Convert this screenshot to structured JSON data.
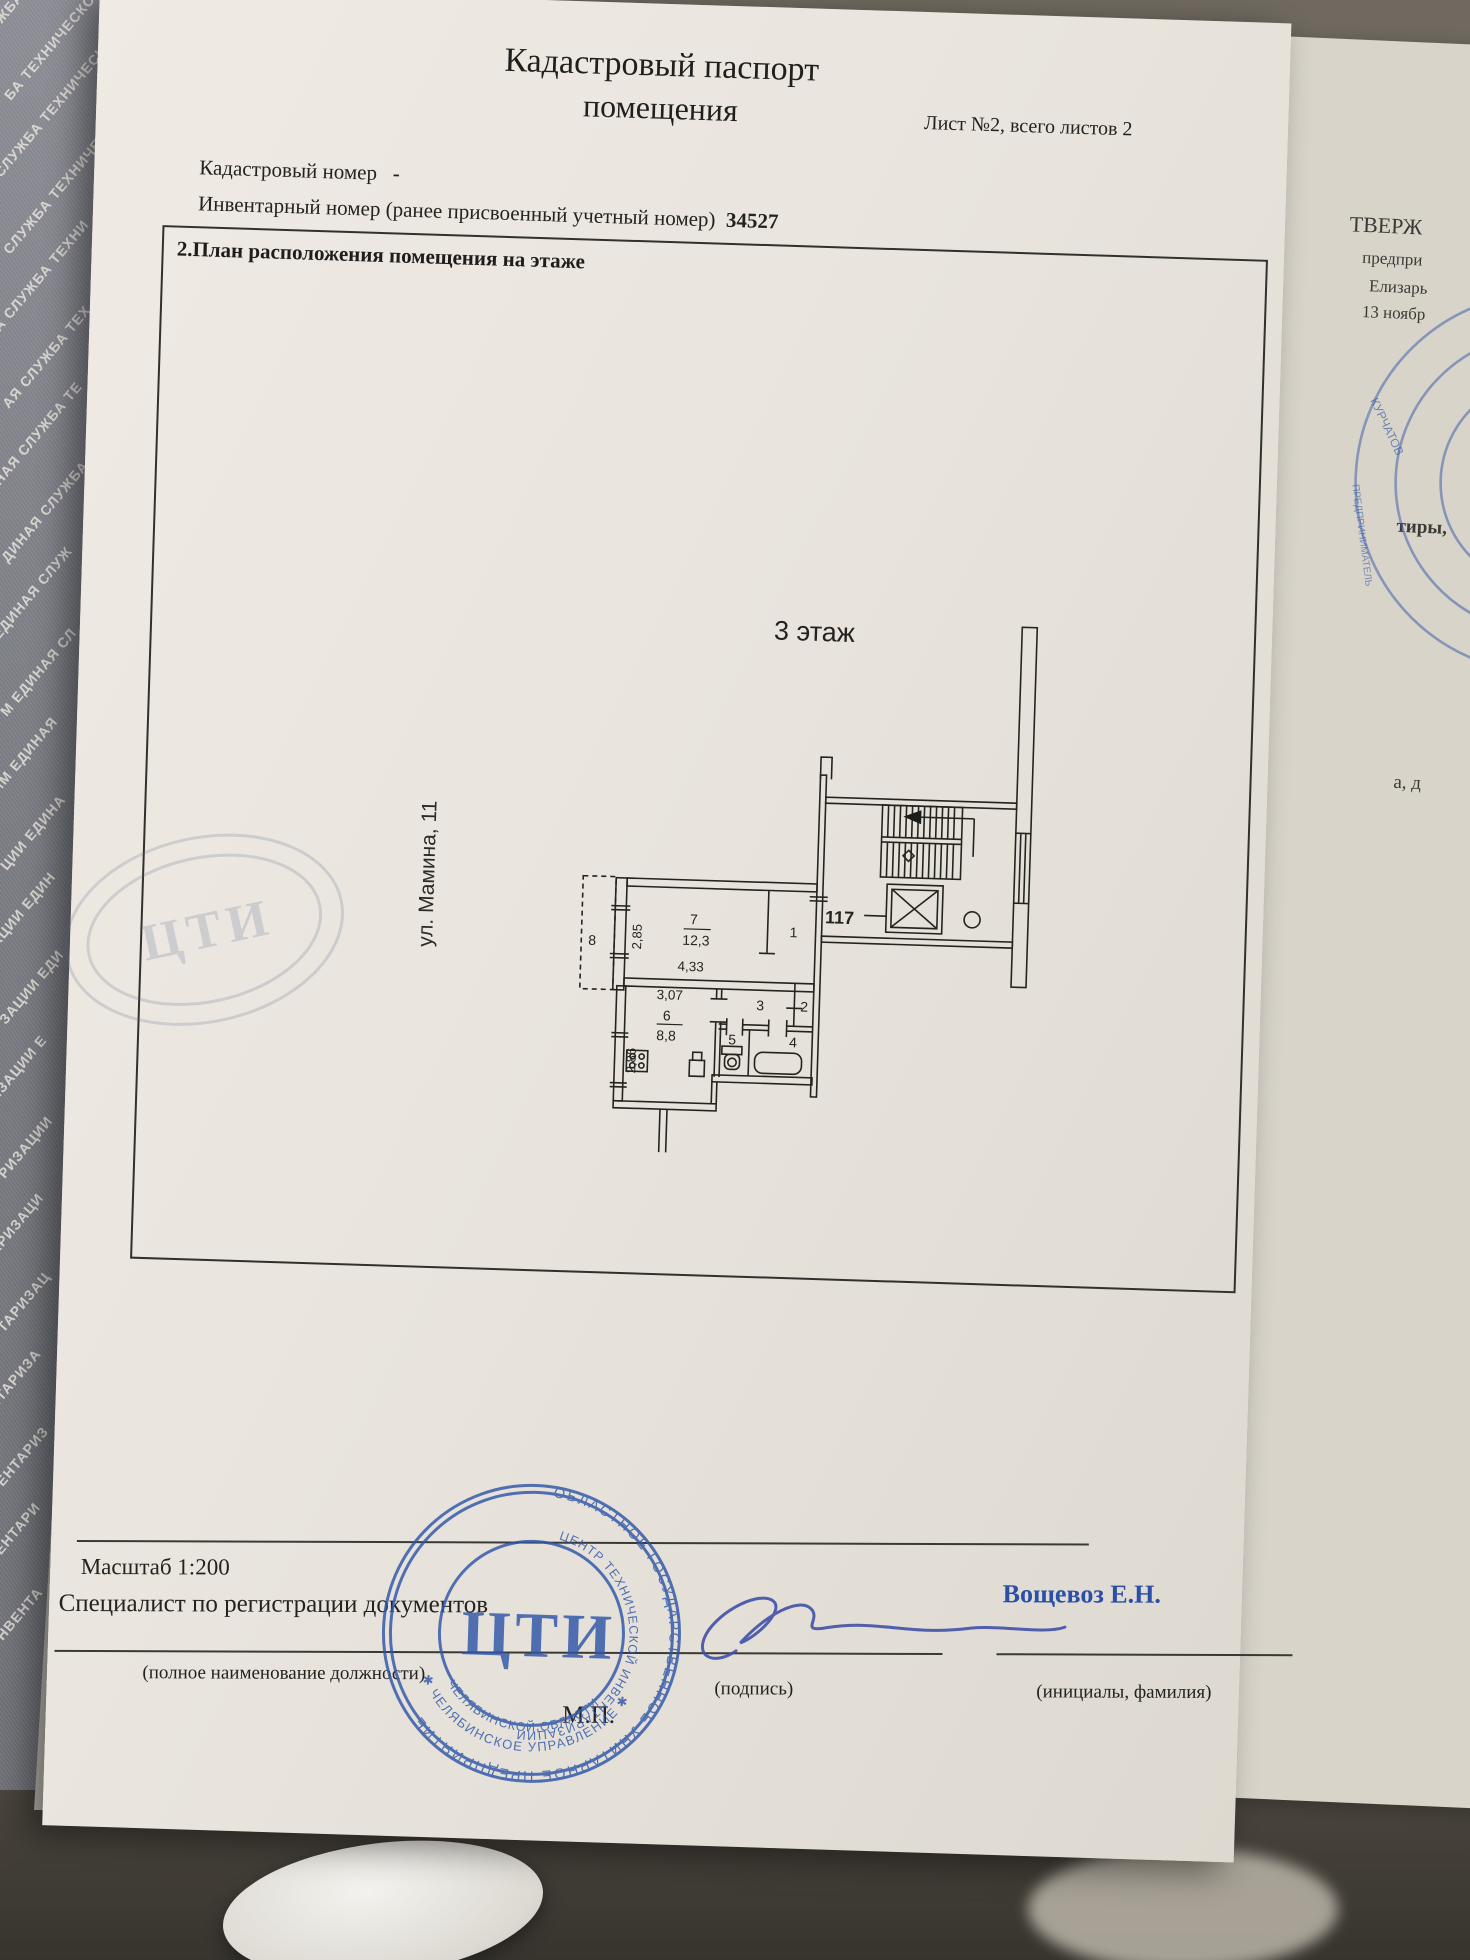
{
  "document": {
    "title_line1": "Кадастровый паспорт",
    "title_line2": "помещения",
    "sheet_info": "Лист №2, всего листов 2",
    "cadastral_number_label": "Кадастровый номер",
    "cadastral_number_value": "-",
    "inventory_number_label": "Инвентарный номер (ранее присвоенный учетный номер)",
    "inventory_number_value": "34527",
    "section_heading": "2.План расположения помещения на этаже"
  },
  "plan": {
    "floor_label": "3 этаж",
    "street_label": "ул. Мамина, 11",
    "apartment_number": "117",
    "room7_number": "7",
    "room7_area": "12,3",
    "room6_number": "6",
    "room6_area": "8,8",
    "room1": "1",
    "room2": "2",
    "room3": "3",
    "room4": "4",
    "room5": "5",
    "room8": "8",
    "dim_room7_width": "4,33",
    "dim_room7_height": "2,85",
    "dim_hall": "3,07",
    "dim_room6_height": "2,86"
  },
  "footer": {
    "scale_label": "Масштаб 1:200",
    "specialist_label": "Специалист по регистрации документов",
    "position_note": "(полное наименование должности)",
    "signature_note": "(подпись)",
    "initials_note": "(инициалы, фамилия)",
    "registrar_name": "Вощевоз Е.Н.",
    "stamp_place": "М.П."
  },
  "stamp": {
    "center_text": "ЦТИ",
    "arc_top": "ОБЛАСТНОЕ ГОСУДАРСТВЕННОЕ УНИТАРНОЕ ПРЕДПРИЯТИЕ",
    "arc_inner_top": "ЦЕНТР ТЕХНИЧЕСКОЙ ИНВЕНТАРИЗАЦИИ",
    "arc_inner_bottom": "ЧЕЛЯБИНСКОЙ ОБЛАСТИ",
    "arc_bottom": "✱ ЧЕЛЯБИНСКОЕ УПРАВЛЕНИЕ ✱"
  },
  "faint_stamp": {
    "text": "ЦТИ"
  },
  "side_page": {
    "fragment1": "ТВЕРЖ",
    "fragment2": "предпри",
    "fragment3": "Елизарь",
    "fragment4": "13 ноябр",
    "fragment5": "тиры,",
    "fragment6": "а, д",
    "stamp_fragment1": "КУРЧАТОВ",
    "stamp_fragment2": "ПРЕДПРИНИМАТЕЛЬ"
  },
  "booklet": {
    "fragments": [
      "ЖБА ТЕХНИЧЕСКОЙ",
      "БА ТЕХНИЧЕСКОЙ",
      "СЛУЖБА ТЕХНИЧЕСК",
      "СЛУЖБА ТЕХНИЧЕС",
      "А СЛУЖБА ТЕХНИ",
      "АЯ СЛУЖБА ТЕХ",
      "НАЯ СЛУЖБА ТЕ",
      "ДИНАЯ СЛУЖБА",
      "ЕДИНАЯ СЛУЖ",
      "М ЕДИНАЯ СЛ",
      "ИМ ЕДИНАЯ",
      "ЦИИ ЕДИНА",
      "АЦИИ ЕДИН",
      "ЗАЦИИ ЕДИ",
      "ИЗАЦИИ Е",
      "РИЗАЦИИ",
      "АРИЗАЦИ",
      "ТАРИЗАЦ",
      "НТАРИЗА",
      "ЕНТАРИЗ",
      "ВЕНТАРИ",
      "НВЕНТА"
    ]
  },
  "colors": {
    "stamp_blue": "#2f56a8",
    "ink_blue": "#3a52aa",
    "paper": "#eae7e1",
    "cover_gray": "#7f8089"
  }
}
